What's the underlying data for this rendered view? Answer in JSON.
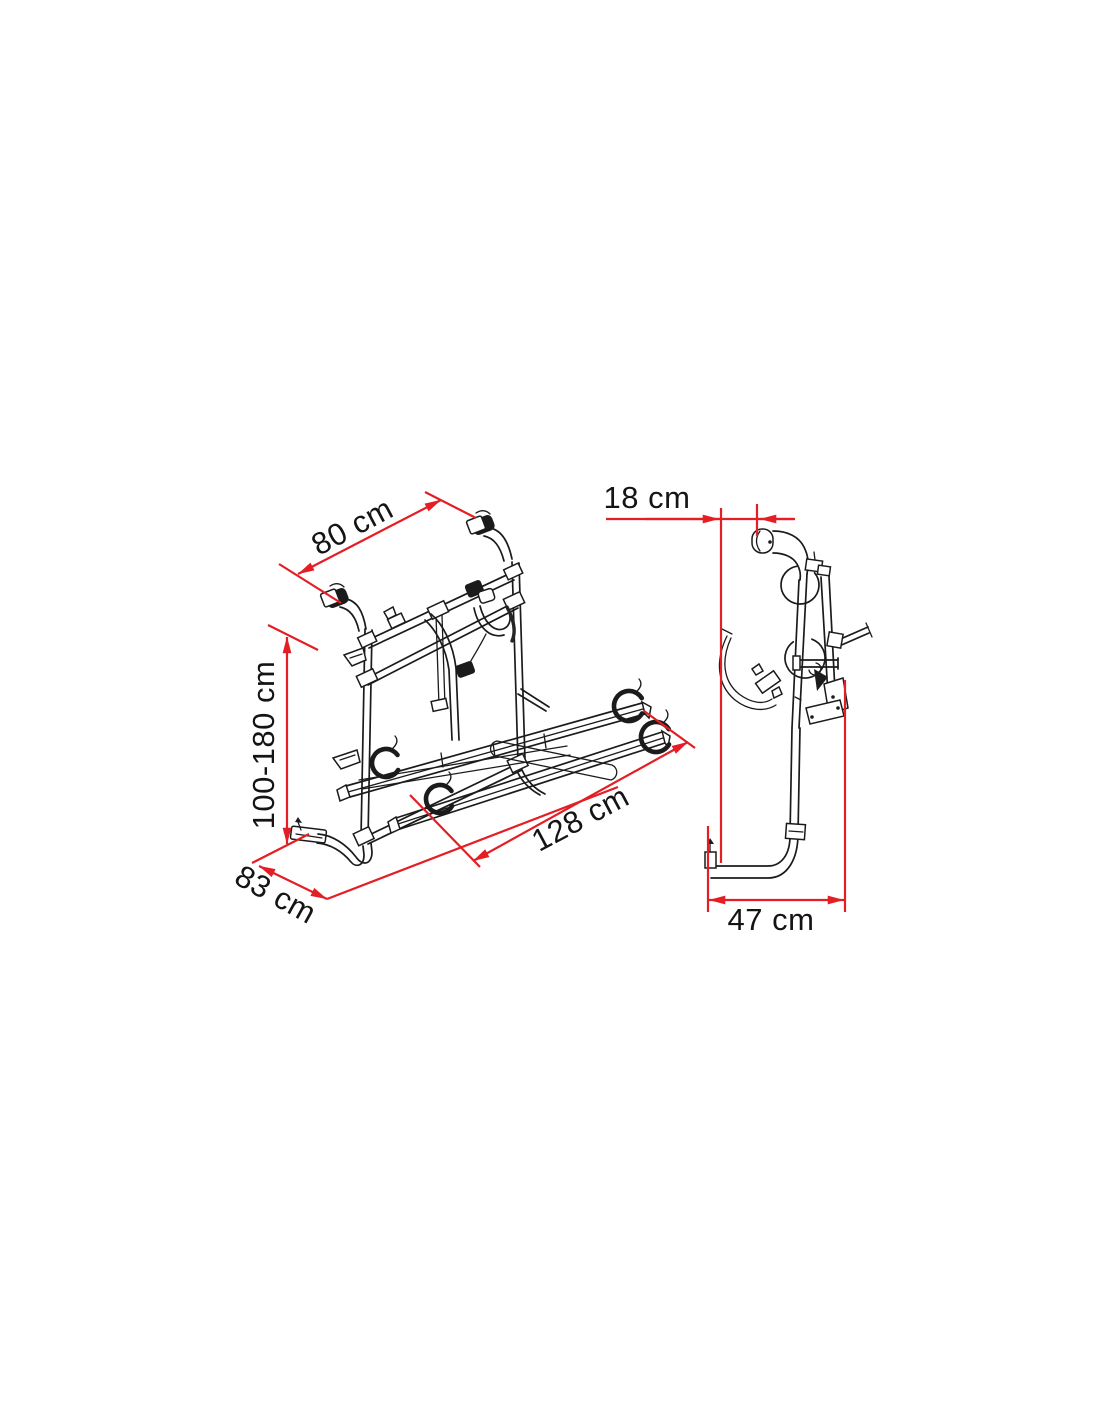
{
  "diagram": {
    "subject": "bike-carrier-dimension-drawing",
    "dimensions": {
      "top_width": "80 cm",
      "wall_offset": "18 cm",
      "height_range": "100-180 cm",
      "rail_length": "128 cm",
      "bottom_width": "83 cm",
      "foot_depth": "47 cm"
    },
    "colors": {
      "dimension_red": "#e31e24",
      "line_black": "#1b1b1b",
      "background": "#ffffff"
    }
  }
}
